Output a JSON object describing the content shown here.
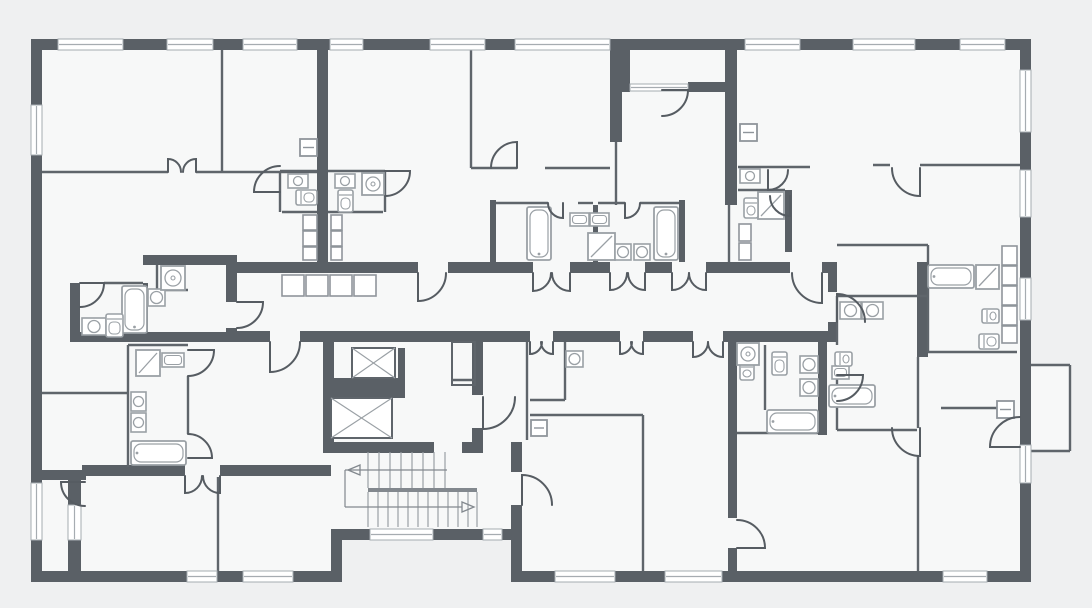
{
  "palette": {
    "background": "#eff0f1",
    "room": "#f7f8f8",
    "wall": "#5a6066",
    "thin": "#5f656b",
    "door": "#565c62",
    "fixture": "#9aa0a5",
    "duct": "#8f959b",
    "window_line": "#a6acb1",
    "stair_line": "#9aa0a5",
    "walk_line": "#82888e",
    "white": "#ffffff"
  },
  "plan": {
    "fills": [
      [
        36,
        44,
        990,
        533
      ],
      [
        1031,
        365,
        39,
        86
      ]
    ],
    "carves": [
      [
        342,
        540,
        169,
        42
      ]
    ],
    "walls": [
      [
        31,
        39,
        1000,
        11
      ],
      [
        31,
        39,
        11,
        543
      ],
      [
        1020,
        39,
        11,
        543
      ],
      [
        31,
        571,
        311,
        11
      ],
      [
        331,
        529,
        11,
        53
      ],
      [
        342,
        529,
        180,
        11
      ],
      [
        511,
        529,
        11,
        53
      ],
      [
        511,
        571,
        520,
        11
      ],
      [
        622,
        50,
        8,
        42
      ],
      [
        727,
        50,
        10,
        42
      ],
      [
        688,
        82,
        39,
        10
      ],
      [
        31,
        470,
        55,
        10
      ],
      [
        68,
        470,
        13,
        35
      ],
      [
        68,
        540,
        13,
        31
      ],
      [
        317,
        50,
        11,
        212
      ],
      [
        610,
        50,
        12,
        92
      ],
      [
        725,
        50,
        12,
        155
      ],
      [
        237,
        262,
        181,
        11
      ],
      [
        448,
        262,
        85,
        11
      ],
      [
        570,
        262,
        40,
        11
      ],
      [
        645,
        262,
        27,
        11
      ],
      [
        706,
        262,
        84,
        11
      ],
      [
        822,
        262,
        8,
        11
      ],
      [
        226,
        262,
        11,
        40
      ],
      [
        226,
        328,
        11,
        14
      ],
      [
        828,
        262,
        9,
        30
      ],
      [
        828,
        322,
        9,
        20
      ],
      [
        237,
        331,
        33,
        11
      ],
      [
        300,
        331,
        23,
        11
      ],
      [
        477,
        331,
        53,
        11
      ],
      [
        553,
        331,
        67,
        11
      ],
      [
        643,
        331,
        50,
        11
      ],
      [
        723,
        331,
        107,
        11
      ],
      [
        323,
        331,
        160,
        11
      ],
      [
        323,
        342,
        11,
        111
      ],
      [
        472,
        342,
        11,
        53
      ],
      [
        472,
        428,
        11,
        14
      ],
      [
        334,
        378,
        71,
        20
      ],
      [
        398,
        348,
        7,
        30
      ],
      [
        323,
        442,
        111,
        11
      ],
      [
        462,
        442,
        21,
        11
      ],
      [
        511,
        442,
        11,
        30
      ],
      [
        511,
        505,
        11,
        24
      ],
      [
        143,
        255,
        94,
        10
      ],
      [
        70,
        283,
        10,
        49
      ],
      [
        70,
        332,
        167,
        10
      ],
      [
        143,
        283,
        5,
        49
      ],
      [
        82,
        465,
        103,
        11
      ],
      [
        220,
        465,
        111,
        11
      ],
      [
        728,
        342,
        9,
        176
      ],
      [
        728,
        548,
        9,
        23
      ],
      [
        818,
        342,
        9,
        93
      ],
      [
        917,
        262,
        11,
        95
      ],
      [
        490,
        200,
        6,
        62
      ],
      [
        679,
        200,
        6,
        62
      ],
      [
        593,
        205,
        5,
        57
      ],
      [
        785,
        190,
        7,
        62
      ]
    ],
    "windows": [
      [
        58,
        39,
        65,
        11
      ],
      [
        167,
        39,
        46,
        11
      ],
      [
        243,
        39,
        54,
        11
      ],
      [
        330,
        39,
        33,
        11
      ],
      [
        430,
        39,
        55,
        11
      ],
      [
        515,
        39,
        95,
        11
      ],
      [
        745,
        39,
        55,
        11
      ],
      [
        853,
        39,
        62,
        11
      ],
      [
        960,
        39,
        45,
        11
      ],
      [
        630,
        84,
        58,
        7
      ],
      [
        31,
        105,
        11,
        50
      ],
      [
        31,
        483,
        11,
        57
      ],
      [
        1020,
        70,
        11,
        62
      ],
      [
        1020,
        170,
        11,
        47
      ],
      [
        1020,
        278,
        11,
        42
      ],
      [
        1020,
        445,
        11,
        38
      ],
      [
        187,
        571,
        30,
        11
      ],
      [
        243,
        571,
        50,
        11
      ],
      [
        555,
        571,
        60,
        11
      ],
      [
        665,
        571,
        57,
        11
      ],
      [
        943,
        571,
        44,
        11
      ],
      [
        370,
        529,
        63,
        11
      ],
      [
        483,
        529,
        19,
        11
      ],
      [
        68,
        505,
        13,
        35
      ]
    ],
    "thin_walls": [
      [
        222,
        50,
        222,
        172
      ],
      [
        42,
        172,
        168,
        172
      ],
      [
        196,
        172,
        317,
        172
      ],
      [
        471,
        50,
        471,
        168
      ],
      [
        471,
        168,
        517,
        168
      ],
      [
        545,
        168,
        610,
        168
      ],
      [
        616,
        142,
        616,
        205
      ],
      [
        729,
        205,
        729,
        262
      ],
      [
        873,
        165,
        890,
        165
      ],
      [
        920,
        165,
        1020,
        165
      ],
      [
        837,
        245,
        928,
        245
      ],
      [
        837,
        296,
        928,
        296
      ],
      [
        928,
        245,
        928,
        352
      ],
      [
        928,
        352,
        1017,
        352
      ],
      [
        918,
        357,
        918,
        428
      ],
      [
        918,
        456,
        918,
        571
      ],
      [
        941,
        408,
        1013,
        408
      ],
      [
        527,
        342,
        527,
        440
      ],
      [
        643,
        415,
        643,
        571
      ],
      [
        530,
        415,
        643,
        415
      ],
      [
        565,
        342,
        565,
        400
      ],
      [
        530,
        400,
        565,
        400
      ],
      [
        218,
        477,
        218,
        571
      ],
      [
        42,
        393,
        128,
        393
      ],
      [
        128,
        345,
        128,
        467
      ],
      [
        128,
        345,
        188,
        345
      ],
      [
        188,
        376,
        188,
        434
      ],
      [
        280,
        171,
        317,
        171
      ],
      [
        328,
        171,
        385,
        171
      ],
      [
        280,
        171,
        280,
        212
      ],
      [
        282,
        212,
        317,
        212
      ],
      [
        328,
        212,
        383,
        212
      ],
      [
        385,
        171,
        385,
        212
      ],
      [
        738,
        167,
        810,
        167
      ],
      [
        738,
        190,
        785,
        190
      ],
      [
        765,
        345,
        765,
        410
      ],
      [
        737,
        433,
        818,
        433
      ],
      [
        104,
        283,
        143,
        283
      ],
      [
        157,
        265,
        157,
        290
      ],
      [
        157,
        290,
        188,
        290
      ],
      [
        496,
        203,
        548,
        203
      ],
      [
        578,
        203,
        593,
        203
      ],
      [
        598,
        203,
        625,
        203
      ],
      [
        640,
        203,
        679,
        203
      ],
      [
        837,
        296,
        837,
        345
      ],
      [
        837,
        375,
        837,
        430
      ],
      [
        837,
        430,
        917,
        430
      ],
      [
        452,
        380,
        475,
        380
      ],
      [
        1031,
        365,
        1070,
        365
      ],
      [
        1070,
        365,
        1070,
        451
      ],
      [
        1031,
        451,
        1070,
        451
      ]
    ],
    "thin_rects": [
      [
        452,
        342,
        23,
        43
      ]
    ],
    "ducts": [
      [
        282,
        275,
        22,
        21
      ],
      [
        306,
        275,
        22,
        21
      ],
      [
        330,
        275,
        22,
        21
      ],
      [
        354,
        275,
        22,
        21
      ],
      [
        303,
        215,
        14,
        15
      ],
      [
        303,
        231,
        14,
        15
      ],
      [
        303,
        247,
        14,
        13
      ],
      [
        331,
        215,
        11,
        15
      ],
      [
        331,
        231,
        11,
        15
      ],
      [
        331,
        247,
        11,
        13
      ],
      [
        739,
        224,
        12,
        17
      ],
      [
        739,
        243,
        12,
        17
      ],
      [
        1002,
        246,
        15,
        19
      ],
      [
        1002,
        266,
        15,
        19
      ],
      [
        1002,
        286,
        15,
        19
      ],
      [
        1002,
        306,
        15,
        19
      ],
      [
        1002,
        326,
        15,
        17
      ]
    ],
    "wall_boxes": [
      [
        300,
        139,
        17,
        17
      ],
      [
        740,
        124,
        17,
        17
      ],
      [
        531,
        420,
        16,
        16
      ],
      [
        997,
        401,
        17,
        17
      ]
    ],
    "elevators": [
      [
        352,
        348,
        43,
        30
      ],
      [
        331,
        398,
        61,
        40
      ]
    ],
    "fixtures": {
      "tubs": [
        [
          122,
          286,
          25,
          47
        ],
        [
          131,
          441,
          55,
          24
        ],
        [
          527,
          207,
          24,
          53
        ],
        [
          654,
          207,
          24,
          53
        ],
        [
          928,
          265,
          46,
          23
        ],
        [
          767,
          410,
          51,
          23
        ],
        [
          829,
          385,
          46,
          22
        ]
      ],
      "showers": [
        [
          136,
          350,
          24,
          26
        ],
        [
          588,
          233,
          27,
          27
        ],
        [
          758,
          192,
          26,
          27
        ],
        [
          976,
          265,
          23,
          24
        ]
      ],
      "sinks": [
        [
          82,
          318,
          24,
          17
        ],
        [
          148,
          289,
          17,
          17
        ],
        [
          131,
          392,
          15,
          19
        ],
        [
          131,
          413,
          15,
          19
        ],
        [
          615,
          244,
          16,
          16
        ],
        [
          634,
          244,
          16,
          16
        ],
        [
          740,
          169,
          20,
          14
        ],
        [
          840,
          302,
          21,
          17
        ],
        [
          862,
          302,
          21,
          17
        ],
        [
          800,
          356,
          18,
          17
        ],
        [
          800,
          379,
          18,
          17
        ],
        [
          566,
          351,
          17,
          16
        ],
        [
          288,
          174,
          20,
          14
        ],
        [
          335,
          174,
          20,
          14
        ]
      ],
      "sink_basins": [
        [
          570,
          213,
          19,
          13
        ],
        [
          590,
          213,
          19,
          13
        ],
        [
          162,
          353,
          22,
          14
        ],
        [
          832,
          366,
          17,
          13
        ]
      ],
      "toilets": [
        [
          106,
          314,
          17,
          23,
          "v"
        ],
        [
          296,
          190,
          21,
          15,
          "h"
        ],
        [
          338,
          190,
          15,
          22,
          "v"
        ],
        [
          744,
          198,
          14,
          20,
          "v"
        ],
        [
          772,
          352,
          15,
          23,
          "v"
        ],
        [
          982,
          309,
          17,
          14,
          "h"
        ],
        [
          979,
          334,
          20,
          15,
          "h"
        ],
        [
          740,
          362,
          14,
          18,
          "v"
        ],
        [
          835,
          352,
          17,
          14,
          "h"
        ]
      ],
      "washers": [
        [
          161,
          266,
          24,
          24
        ],
        [
          362,
          173,
          22,
          22
        ],
        [
          737,
          343,
          22,
          22
        ]
      ]
    },
    "stairs": {
      "treads_upper": {
        "xs": [
          368,
          379,
          390,
          401,
          412,
          423,
          434,
          445
        ],
        "y1": 452,
        "y2": 488
      },
      "treads_lower": {
        "xs": [
          368,
          378,
          388,
          398,
          408,
          418,
          428,
          438,
          448,
          458,
          468,
          477
        ],
        "y1": 492,
        "y2": 527
      },
      "landing": [
        368,
        488,
        109,
        4
      ],
      "walk": [
        [
          345,
          470,
          447,
          470
        ],
        [
          345,
          470,
          345,
          507
        ],
        [
          345,
          507,
          462,
          507
        ]
      ],
      "arrows": [
        [
          360,
          465,
          360,
          475,
          348,
          470
        ],
        [
          462,
          502,
          462,
          512,
          474,
          507
        ]
      ]
    },
    "doors": [
      "M168,172 L168,159 A13,13 0 0 1 181,172",
      "M196,172 L196,159 A13,13 0 0 0 183,172",
      "M80,283 L104,283 A24,24 0 0 1 80,307",
      "M237,302 L263,302 A26,26 0 0 1 237,328",
      "M280,192 L254,192 A26,26 0 0 1 280,166",
      "M385,171 L410,171 A25,25 0 0 1 385,196",
      "M517,168 L517,142 A26,26 0 0 0 491,168",
      "M563,203 L563,218 A15,15 0 0 1 548,203",
      "M625,203 L625,218 A15,15 0 0 0 640,203",
      "M662,90 L688,90 A26,26 0 0 1 662,116",
      "M768,170 L768,190 A20,20 0 0 0 788,170",
      "M920,168 L920,196 A28,28 0 0 1 892,168",
      "M418,273 L418,301 A28,28 0 0 0 446,273",
      "M533,273 L533,291 A18,18 0 0 0 551,273",
      "M570,273 L570,291 A18,18 0 0 1 552,273",
      "M610,273 L610,290 A17,17 0 0 0 627,273",
      "M645,273 L645,290 A17,17 0 0 1 628,273",
      "M672,273 L672,290 A17,17 0 0 0 689,273",
      "M706,273 L706,290 A17,17 0 0 1 689,273",
      "M822,273 L822,303 A30,30 0 0 1 792,273",
      "M270,342 L270,372 A30,30 0 0 0 300,342",
      "M530,342 L530,354 A12,12 0 0 0 542,342",
      "M553,342 L553,354 A12,12 0 0 1 541,342",
      "M620,342 L620,354 A12,12 0 0 0 632,342",
      "M643,342 L643,354 A12,12 0 0 1 631,342",
      "M693,342 L693,357 A15,15 0 0 0 708,342",
      "M723,342 L723,357 A15,15 0 0 1 708,342",
      "M837,322 L837,294 A28,28 0 0 1 865,322",
      "M483,397 L483,429 A32,32 0 0 0 515,397",
      "M522,505 L522,475 A30,30 0 0 1 552,505",
      "M85,482 L61,482 A24,24 0 0 0 85,506",
      "M185,476 L185,493 A17,17 0 0 0 202,476",
      "M220,476 L220,493 A17,17 0 0 1 203,476",
      "M188,350 L214,350 A26,26 0 0 1 188,376",
      "M188,458 L212,458 A24,24 0 0 0 188,434",
      "M737,548 L765,548 A28,28 0 0 0 737,520",
      "M920,428 L920,456 A28,28 0 0 1 892,428",
      "M1020,447 L990,447 A30,30 0 0 1 1020,417",
      "M790,196 L790,216 A20,20 0 0 1 770,196",
      "M837,375 L863,375 A26,26 0 0 1 837,401"
    ]
  }
}
